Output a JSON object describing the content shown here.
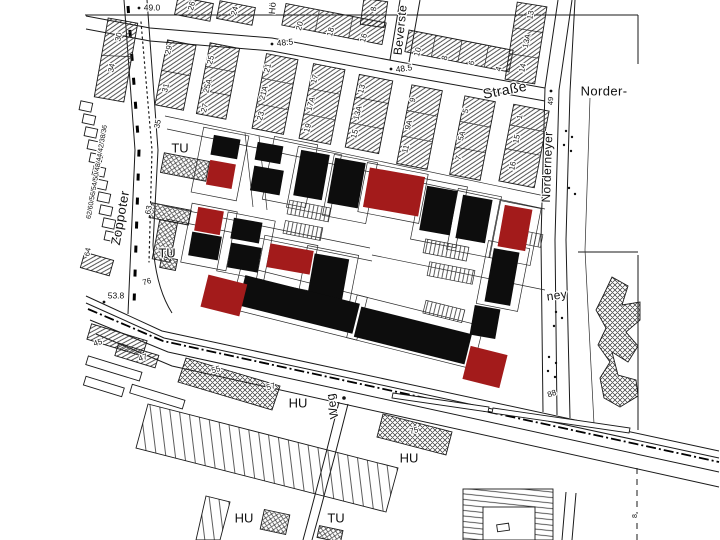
{
  "title": "Cadastral city map extract with highlighted building footprints",
  "colors": {
    "background": "#ffffff",
    "line_ink": "#1a1a1a",
    "building_black": "#0d0d0d",
    "building_highlight_red": "#a31b1b",
    "gridline_gray": "#444444"
  },
  "legend_note": "",
  "labels": [
    {
      "t": "Zoppoter",
      "x": 121,
      "y": 218,
      "r": -80,
      "s": 13,
      "k": "street",
      "n": "street-label-zoppoter"
    },
    {
      "t": "Beverste",
      "x": 401,
      "y": 30,
      "r": -84,
      "s": 12,
      "k": "street",
      "n": "street-label-beverstedter"
    },
    {
      "t": "Straße",
      "x": 505,
      "y": 91,
      "r": -11,
      "s": 14,
      "k": "street",
      "n": "street-label-strasse"
    },
    {
      "t": "Norder-",
      "x": 604,
      "y": 92,
      "r": 0,
      "s": 13,
      "k": "street",
      "n": "street-label-norder"
    },
    {
      "t": "Norderneyer",
      "x": 548,
      "y": 167,
      "r": -88,
      "s": 12,
      "k": "street",
      "n": "street-label-norderneyer"
    },
    {
      "t": "ney",
      "x": 557,
      "y": 296,
      "r": -8,
      "s": 12,
      "k": "street",
      "n": "street-label-ney"
    },
    {
      "t": "Weg",
      "x": 333,
      "y": 406,
      "r": -100,
      "s": 12,
      "k": "street",
      "n": "street-label-weg"
    },
    {
      "t": "Hö",
      "x": 273,
      "y": 8,
      "r": -85,
      "s": 9,
      "k": "street",
      "n": "street-label-partial"
    },
    {
      "t": "TU",
      "x": 180,
      "y": 149,
      "r": 0,
      "s": 13,
      "k": "area",
      "n": "use-label-tu-1"
    },
    {
      "t": "TU",
      "x": 167,
      "y": 254,
      "r": 0,
      "s": 13,
      "k": "area",
      "n": "use-label-tu-2"
    },
    {
      "t": "TU",
      "x": 336,
      "y": 519,
      "r": 0,
      "s": 13,
      "k": "area",
      "n": "use-label-tu-3"
    },
    {
      "t": "HU",
      "x": 298,
      "y": 404,
      "r": 0,
      "s": 13,
      "k": "area",
      "n": "use-label-hu-1"
    },
    {
      "t": "HU",
      "x": 409,
      "y": 459,
      "r": 0,
      "s": 13,
      "k": "area",
      "n": "use-label-hu-2"
    },
    {
      "t": "HU",
      "x": 244,
      "y": 519,
      "r": 0,
      "s": 13,
      "k": "area",
      "n": "use-label-hu-3"
    },
    {
      "t": "49.0",
      "x": 152,
      "y": 8,
      "r": 0,
      "s": 8.5,
      "k": "elev",
      "n": "elevation-label"
    },
    {
      "t": "48.5",
      "x": 285,
      "y": 43,
      "r": -6,
      "s": 8.5,
      "k": "elev",
      "n": "elevation-label"
    },
    {
      "t": "48.5",
      "x": 404,
      "y": 69,
      "r": -8,
      "s": 8.5,
      "k": "elev",
      "n": "elevation-label"
    },
    {
      "t": "53.8",
      "x": 116,
      "y": 296,
      "r": 0,
      "s": 8.5,
      "k": "elev",
      "n": "elevation-label"
    },
    {
      "t": "49",
      "x": 551,
      "y": 101,
      "r": -87,
      "s": 7.5,
      "k": "elev",
      "n": "elevation-label"
    },
    {
      "t": "30",
      "x": 119,
      "y": 37,
      "r": -78,
      "s": 8,
      "k": "num",
      "n": "house-number"
    },
    {
      "t": "34",
      "x": 112,
      "y": 68,
      "r": -78,
      "s": 8,
      "k": "num",
      "n": "house-number"
    },
    {
      "t": "62/60/56/54/50/48/44/42/38/36",
      "x": 97,
      "y": 172,
      "r": -80,
      "s": 7,
      "k": "num",
      "n": "house-number-row"
    },
    {
      "t": "64",
      "x": 88,
      "y": 252,
      "r": -80,
      "s": 7.5,
      "k": "num",
      "n": "house-number"
    },
    {
      "t": "35",
      "x": 158,
      "y": 124,
      "r": -78,
      "s": 8,
      "k": "num",
      "n": "house-number"
    },
    {
      "t": "63",
      "x": 149,
      "y": 210,
      "r": -80,
      "s": 8,
      "k": "num",
      "n": "house-number"
    },
    {
      "t": "76",
      "x": 147,
      "y": 282,
      "r": -15,
      "s": 8,
      "k": "num",
      "n": "house-number"
    },
    {
      "t": "26",
      "x": 192,
      "y": 6,
      "r": -75,
      "s": 8,
      "k": "num",
      "n": "house-number"
    },
    {
      "t": "24",
      "x": 235,
      "y": 11,
      "r": -75,
      "s": 8,
      "k": "num",
      "n": "house-number"
    },
    {
      "t": "8",
      "x": 374,
      "y": 9,
      "r": -80,
      "s": 8,
      "k": "num",
      "n": "house-number"
    },
    {
      "t": "29",
      "x": 169,
      "y": 50,
      "r": -75,
      "s": 8,
      "k": "num",
      "n": "house-number"
    },
    {
      "t": "31",
      "x": 166,
      "y": 88,
      "r": -75,
      "s": 8,
      "k": "num",
      "n": "house-number"
    },
    {
      "t": "25",
      "x": 211,
      "y": 60,
      "r": -75,
      "s": 8,
      "k": "num",
      "n": "house-number"
    },
    {
      "t": "25A",
      "x": 208,
      "y": 86,
      "r": -75,
      "s": 8,
      "k": "num",
      "n": "house-number"
    },
    {
      "t": "27",
      "x": 205,
      "y": 108,
      "r": -75,
      "s": 8,
      "k": "num",
      "n": "house-number"
    },
    {
      "t": "21",
      "x": 268,
      "y": 68,
      "r": -75,
      "s": 8,
      "k": "num",
      "n": "house-number"
    },
    {
      "t": "21A",
      "x": 264,
      "y": 93,
      "r": -75,
      "s": 8,
      "k": "num",
      "n": "house-number"
    },
    {
      "t": "23",
      "x": 261,
      "y": 116,
      "r": -75,
      "s": 8,
      "k": "num",
      "n": "house-number"
    },
    {
      "t": "17",
      "x": 315,
      "y": 79,
      "r": -75,
      "s": 8,
      "k": "num",
      "n": "house-number"
    },
    {
      "t": "17A",
      "x": 311,
      "y": 104,
      "r": -75,
      "s": 8,
      "k": "num",
      "n": "house-number"
    },
    {
      "t": "19",
      "x": 308,
      "y": 128,
      "r": -75,
      "s": 8,
      "k": "num",
      "n": "house-number"
    },
    {
      "t": "13",
      "x": 362,
      "y": 89,
      "r": -75,
      "s": 8,
      "k": "num",
      "n": "house-number"
    },
    {
      "t": "13A",
      "x": 358,
      "y": 113,
      "r": -75,
      "s": 8,
      "k": "num",
      "n": "house-number"
    },
    {
      "t": "15",
      "x": 355,
      "y": 134,
      "r": -75,
      "s": 8,
      "k": "num",
      "n": "house-number"
    },
    {
      "t": "20",
      "x": 300,
      "y": 26,
      "r": -75,
      "s": 8,
      "k": "num",
      "n": "house-number"
    },
    {
      "t": "18",
      "x": 331,
      "y": 32,
      "r": -75,
      "s": 8,
      "k": "num",
      "n": "house-number"
    },
    {
      "t": "16",
      "x": 364,
      "y": 38,
      "r": -75,
      "s": 8,
      "k": "num",
      "n": "house-number"
    },
    {
      "t": "10",
      "x": 418,
      "y": 52,
      "r": -75,
      "s": 8,
      "k": "num",
      "n": "house-number"
    },
    {
      "t": "8",
      "x": 445,
      "y": 58,
      "r": -75,
      "s": 8,
      "k": "num",
      "n": "house-number"
    },
    {
      "t": "6",
      "x": 472,
      "y": 63,
      "r": -75,
      "s": 8,
      "k": "num",
      "n": "house-number"
    },
    {
      "t": "4",
      "x": 499,
      "y": 69,
      "r": -75,
      "s": 8,
      "k": "num",
      "n": "house-number"
    },
    {
      "t": "9",
      "x": 413,
      "y": 100,
      "r": -75,
      "s": 8,
      "k": "num",
      "n": "house-number"
    },
    {
      "t": "9A",
      "x": 409,
      "y": 125,
      "r": -75,
      "s": 8,
      "k": "num",
      "n": "house-number"
    },
    {
      "t": "11",
      "x": 406,
      "y": 149,
      "r": -75,
      "s": 8,
      "k": "num",
      "n": "house-number"
    },
    {
      "t": "5",
      "x": 466,
      "y": 111,
      "r": -75,
      "s": 8,
      "k": "num",
      "n": "house-number"
    },
    {
      "t": "5A",
      "x": 462,
      "y": 136,
      "r": -75,
      "s": 8,
      "k": "num",
      "n": "house-number"
    },
    {
      "t": "7",
      "x": 459,
      "y": 158,
      "r": -75,
      "s": 8,
      "k": "num",
      "n": "house-number"
    },
    {
      "t": "13",
      "x": 531,
      "y": 15,
      "r": -78,
      "s": 8,
      "k": "num",
      "n": "house-number"
    },
    {
      "t": "13A",
      "x": 527,
      "y": 41,
      "r": -78,
      "s": 8,
      "k": "num",
      "n": "house-number"
    },
    {
      "t": "14",
      "x": 523,
      "y": 68,
      "r": -78,
      "s": 8,
      "k": "num",
      "n": "house-number"
    },
    {
      "t": "1",
      "x": 520,
      "y": 117,
      "r": -78,
      "s": 8,
      "k": "num",
      "n": "house-number"
    },
    {
      "t": "15",
      "x": 517,
      "y": 139,
      "r": -78,
      "s": 8,
      "k": "num",
      "n": "house-number"
    },
    {
      "t": "16",
      "x": 513,
      "y": 166,
      "r": -78,
      "s": 8,
      "k": "num",
      "n": "house-number"
    },
    {
      "t": "88",
      "x": 552,
      "y": 394,
      "r": -20,
      "s": 8,
      "k": "num",
      "n": "house-number"
    },
    {
      "t": "45",
      "x": 98,
      "y": 343,
      "r": -18,
      "s": 8,
      "k": "num",
      "n": "house-number"
    },
    {
      "t": "47",
      "x": 143,
      "y": 358,
      "r": -18,
      "s": 8,
      "k": "num",
      "n": "house-number"
    },
    {
      "t": "55",
      "x": 216,
      "y": 370,
      "r": -16,
      "s": 8,
      "k": "num",
      "n": "house-number"
    },
    {
      "t": "57",
      "x": 271,
      "y": 387,
      "r": -16,
      "s": 8,
      "k": "num",
      "n": "house-number"
    },
    {
      "t": "75",
      "x": 414,
      "y": 431,
      "r": -14,
      "s": 8,
      "k": "num",
      "n": "house-number"
    },
    {
      "t": "8",
      "x": 635,
      "y": 516,
      "r": -90,
      "s": 7,
      "k": "num",
      "n": "boundary-number"
    }
  ]
}
